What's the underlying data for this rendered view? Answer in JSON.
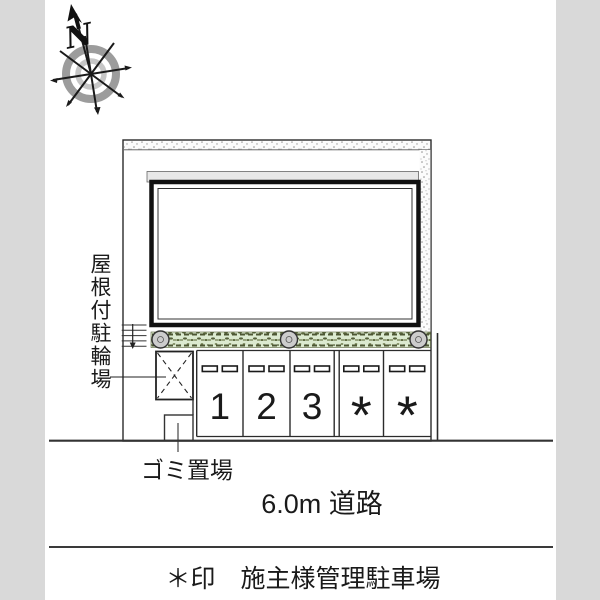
{
  "compass": {
    "north_label": "N"
  },
  "plan": {
    "bicycle_parking_label": "屋根付駐輪場",
    "garbage_area_label": "ゴミ置場",
    "road_label": "6.0m 道路",
    "parking_space_labels": [
      "1",
      "2",
      "3",
      "*",
      "*"
    ]
  },
  "legend": {
    "note": "＊印　施主様管理駐車場"
  },
  "colors": {
    "line": "#2b2b2b",
    "side_margin_gray": "#d9d9d9",
    "hedge_green": "#dcead0",
    "hedge_dark": "#55603a",
    "eave_gray": "#e8e8e8",
    "bush_gray": "#cccccc",
    "compass_ring_gray": "#9c9c9c",
    "stipple_dot": "#8f8f8f"
  }
}
